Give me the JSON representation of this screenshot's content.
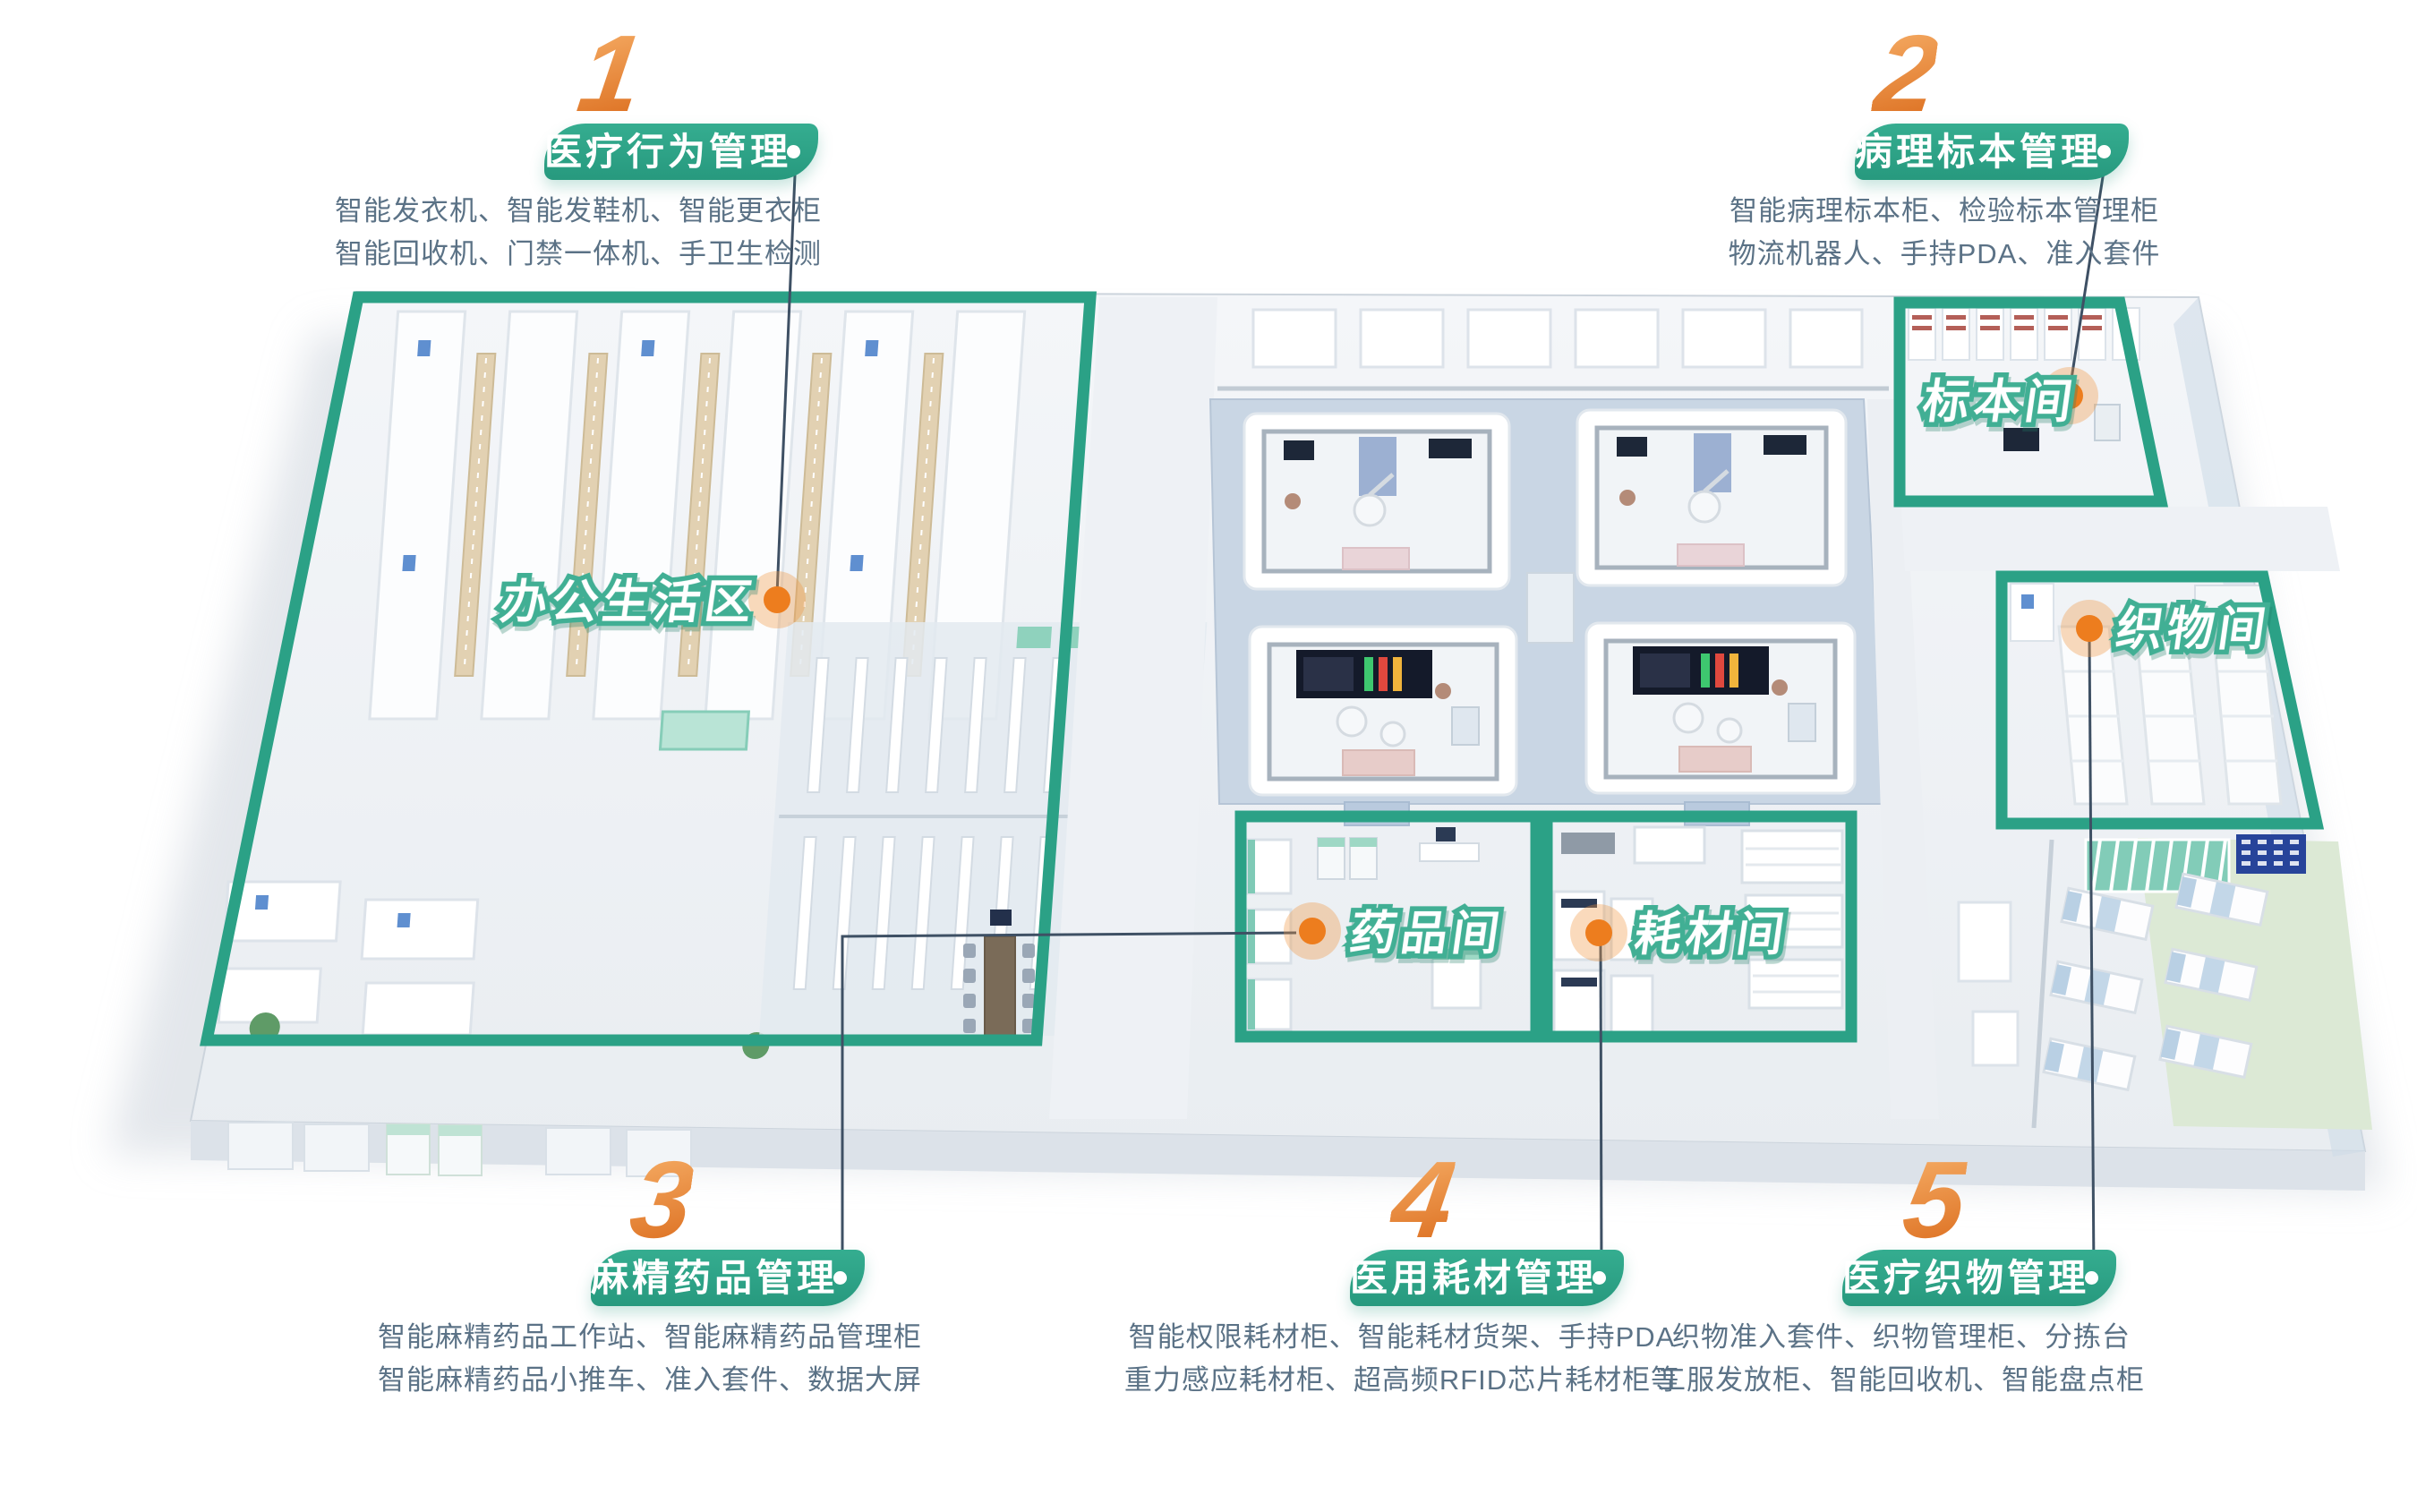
{
  "palette": {
    "banner_green": "#2fa287",
    "zone_outline_green": "#2ba186",
    "room_label_outline": "#41af94",
    "marker_orange": "#ed7d1e",
    "number_gradient_from": "#f3a75f",
    "number_gradient_to": "#df7628",
    "description_text": "#5b7286",
    "connector_line": "#3e5064"
  },
  "callouts": [
    {
      "number": "1",
      "title": "医疗行为管理",
      "desc_lines": [
        "智能发衣机、智能发鞋机、智能更衣柜",
        "智能回收机、门禁一体机、手卫生检测"
      ]
    },
    {
      "number": "2",
      "title": "病理标本管理",
      "desc_lines": [
        "智能病理标本柜、检验标本管理柜",
        "物流机器人、手持PDA、准入套件"
      ]
    },
    {
      "number": "3",
      "title": "麻精药品管理",
      "desc_lines": [
        "智能麻精药品工作站、智能麻精药品管理柜",
        "智能麻精药品小推车、准入套件、数据大屏"
      ]
    },
    {
      "number": "4",
      "title": "医用耗材管理",
      "desc_lines": [
        "智能权限耗材柜、智能耗材货架、手持PDA",
        "重力感应耗材柜、超高频RFID芯片耗材柜等"
      ]
    },
    {
      "number": "5",
      "title": "医疗织物管理",
      "desc_lines": [
        "织物准入套件、织物管理柜、分拣台",
        "工服发放柜、智能回收机、智能盘点柜"
      ]
    }
  ],
  "rooms": [
    {
      "label": "办公生活区"
    },
    {
      "label": "标本间"
    },
    {
      "label": "织物间"
    },
    {
      "label": "药品间"
    },
    {
      "label": "耗材间"
    }
  ]
}
